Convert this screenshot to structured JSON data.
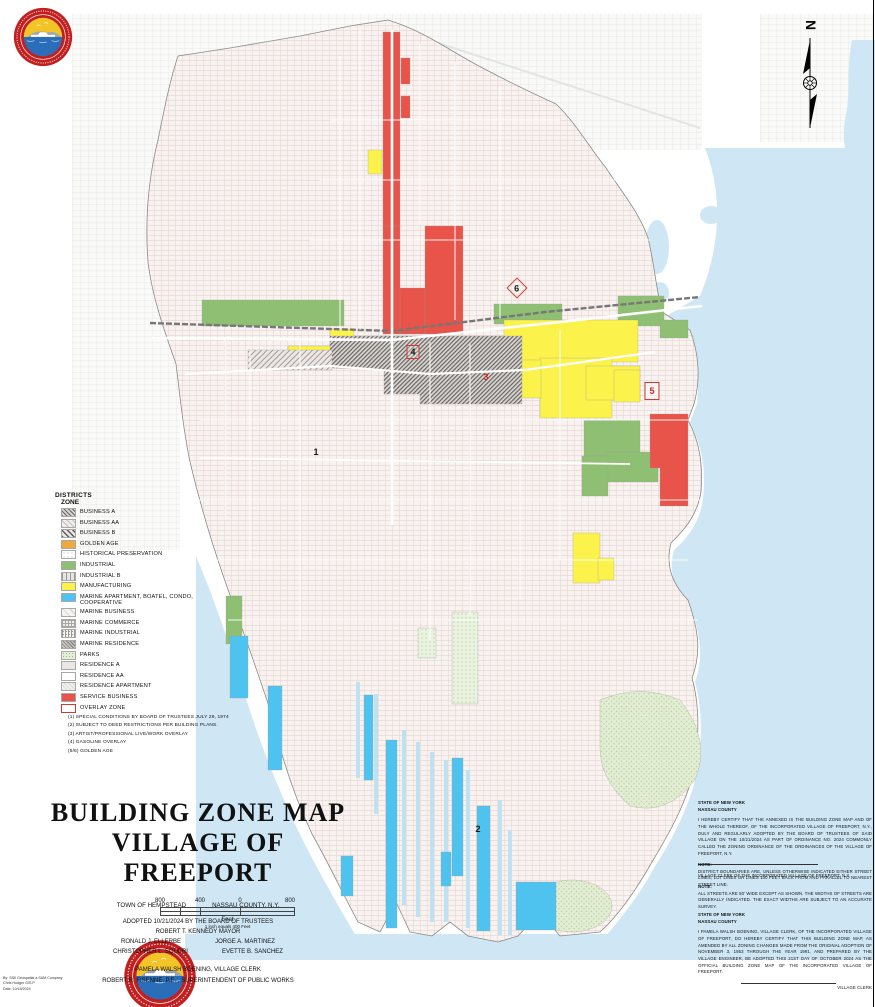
{
  "colors": {
    "water": "#cfe7f4",
    "service_business_red": "#e8534a",
    "manufacturing_yellow": "#fbf24b",
    "industrial_green": "#8fbf72",
    "marine_apartment_cyan": "#4fc3ef",
    "golden_age_orange": "#efa93d",
    "parks_green": "#e6efda",
    "overlay_red": "#d03a30",
    "seal_red": "#c41f1f"
  },
  "compass": {
    "north_label": "N"
  },
  "legend": {
    "title": "DISTRICTS",
    "subtitle": "ZONE",
    "items": [
      {
        "label": "BUSINESS A",
        "swatch": "sw-business-a"
      },
      {
        "label": "BUSINESS AA",
        "swatch": "sw-business-aa"
      },
      {
        "label": "BUSINESS B",
        "swatch": "sw-business-b"
      },
      {
        "label": "GOLDEN AGE",
        "swatch": "sw-golden-age"
      },
      {
        "label": "HISTORICAL PRESERVATION",
        "swatch": "sw-historical"
      },
      {
        "label": "INDUSTRIAL",
        "swatch": "sw-industrial"
      },
      {
        "label": "INDUSTRIAL B",
        "swatch": "sw-industrial-b"
      },
      {
        "label": "MANUFACTURING",
        "swatch": "sw-manufacturing"
      },
      {
        "label": "MARINE APARTMENT, BOATEL, CONDO, COOPERATIVE",
        "swatch": "sw-marine-apartment"
      },
      {
        "label": "MARINE BUSINESS",
        "swatch": "sw-marine-business"
      },
      {
        "label": "MARINE COMMERCE",
        "swatch": "sw-marine-commerce"
      },
      {
        "label": "MARINE INDUSTRIAL",
        "swatch": "sw-marine-industrial"
      },
      {
        "label": "MARINE RESIDENCE",
        "swatch": "sw-marine-residence"
      },
      {
        "label": "PARKS",
        "swatch": "sw-parks"
      },
      {
        "label": "RESIDENCE A",
        "swatch": "sw-residence-a"
      },
      {
        "label": "RESIDENCE AA",
        "swatch": "sw-residence-aa"
      },
      {
        "label": "RESIDENCE APARTMENT",
        "swatch": "sw-residence-apartment"
      },
      {
        "label": "SERVICE BUSINESS",
        "swatch": "sw-service-business"
      },
      {
        "label": "OVERLAY ZONE",
        "swatch": "sw-overlay-zone"
      }
    ],
    "footnotes": [
      "(1) SPECIAL CONDITIONS BY BOARD OF TRUSTEES JULY 29, 1974",
      "(2) SUBJECT TO DEED RESTRICTIONS PER BUILDING PLANS.",
      "(3) ARTIST/PROFESSIONAL LIVE/WORK OVERLAY",
      "(4) GASOLINE OVERLAY",
      "(5/6) GOLDEN AGE"
    ]
  },
  "markers": [
    {
      "label": "1",
      "x": 316,
      "y": 452,
      "style": "m-plain"
    },
    {
      "label": "2",
      "x": 478,
      "y": 829,
      "style": "m-plain"
    },
    {
      "label": "3",
      "x": 486,
      "y": 377,
      "style": "m-red"
    },
    {
      "label": "4",
      "x": 413,
      "y": 352,
      "style": "m-red-box"
    },
    {
      "label": "5",
      "x": 652,
      "y": 391,
      "style": "m-red-box-lg"
    },
    {
      "label": "6",
      "x": 517,
      "y": 288,
      "style": "m-red-diamond"
    }
  ],
  "title_block": {
    "title_line1": "BUILDING ZONE MAP",
    "title_line2": "VILLAGE OF FREEPORT",
    "jurisdiction_left": "TOWN OF HEMPSTEAD",
    "jurisdiction_right": "NASSAU COUNTY, N.Y.",
    "adopted_line": "ADOPTED 10/21/2024 BY THE BOARD OF TRUSTEES",
    "mayor_line": "ROBERT T. KENNEDY MAYOR",
    "trustee_1": "RONALD J. ELLERBE",
    "trustee_2": "JORGE A. MARTINEZ",
    "trustee_3": "CHRISTOPHER L. SQUERI",
    "trustee_4": "EVETTE B. SANCHEZ",
    "clerk_line": "PAMELA WALSH BOENING,     VILLAGE CLERK",
    "engineer_line": "ROBERT R. FISENNE, P.E. ,     SUPERINTENDENT OF PUBLIC WORKS"
  },
  "scale_bar": {
    "labels": [
      "800",
      "400",
      "0",
      "800"
    ],
    "unit": "Feet",
    "ratio_note": "1 inch equals 400 Feet"
  },
  "certification_top": {
    "state": "STATE OF NEW YORK",
    "county": "NASSAU COUNTY",
    "body": "I HEREBY CERTIFY THAT THE ANNEXED IS THE BUILDING ZONE MAP AND OF THE WHOLE THEREOF, OF THE INCORPORATED VILLAGE OF FREEPORT, N.Y., DULY AND REGULARLY ADOPTED BY THE BOARD OF TRUSTEES OF SAID VILLAGE ON THE 10/21/2024 AS PART OF ORDINANCE NO. 2024 COMMONLY CALLED THE ZONING ORDINANCE OF THE ORDINANCES OF THE VILLAGE OF FREEPORT, N.Y.",
    "signature_label": "VILLAGE CLERK OF THE INCORPORATED VILLAGE OF FREEPORT, N.Y."
  },
  "note1": {
    "header": "NOTE:",
    "body": "DISTRICT BOUNDARIES ARE, UNLESS OTHERWISE INDICATED EITHER STREET LINES, LOT LINES OR LINES 100 FEET BACK FROM AND PARALLEL TO NEAREST STREET LINE."
  },
  "note2": {
    "header": "NOTE:",
    "body": "ALL STREETS ARE 50' WIDE EXCEPT AS SHOWN.  THE WIDTHS OF STREETS ARE GENERALLY INDICATED. THE EXACT WIDTHS ARE SUBJECT TO AN ACCURATE SURVEY."
  },
  "certification_bottom": {
    "state": "STATE OF NEW YORK",
    "county": "NASSAU COUNTY",
    "body": "I PAMELA WALSH BOENING, VILLAGE CLERK, OF THE INCORPORATED VILLAGE OF FREEPORT, DO HEREBY CERTIFY THAT THIS BUILDING ZONE MAP, AS AMENDED BY ALL ZONING CHANGES MADE FROM THE ORIGINAL ADOPTION OF NOVEMBER 3, 1953 THROUGH THE YEAR 1991, AND PREPARED BY THE VILLAGE ENGINEER, BE ADOPTED THIS 21ST DAY OF OCTOBER 2024 AS THE OFFICIAL BUILDING ZONE MAP OF THE INCORPORATED VILLAGE OF FREEPORT.",
    "signature_label": "VILLAGE CLERK"
  },
  "credits": {
    "lines": [
      "By: SIDI Geospatial a SAM Company",
      "Chris Hodger GIS.P",
      "Date: 10/18/2024"
    ]
  }
}
